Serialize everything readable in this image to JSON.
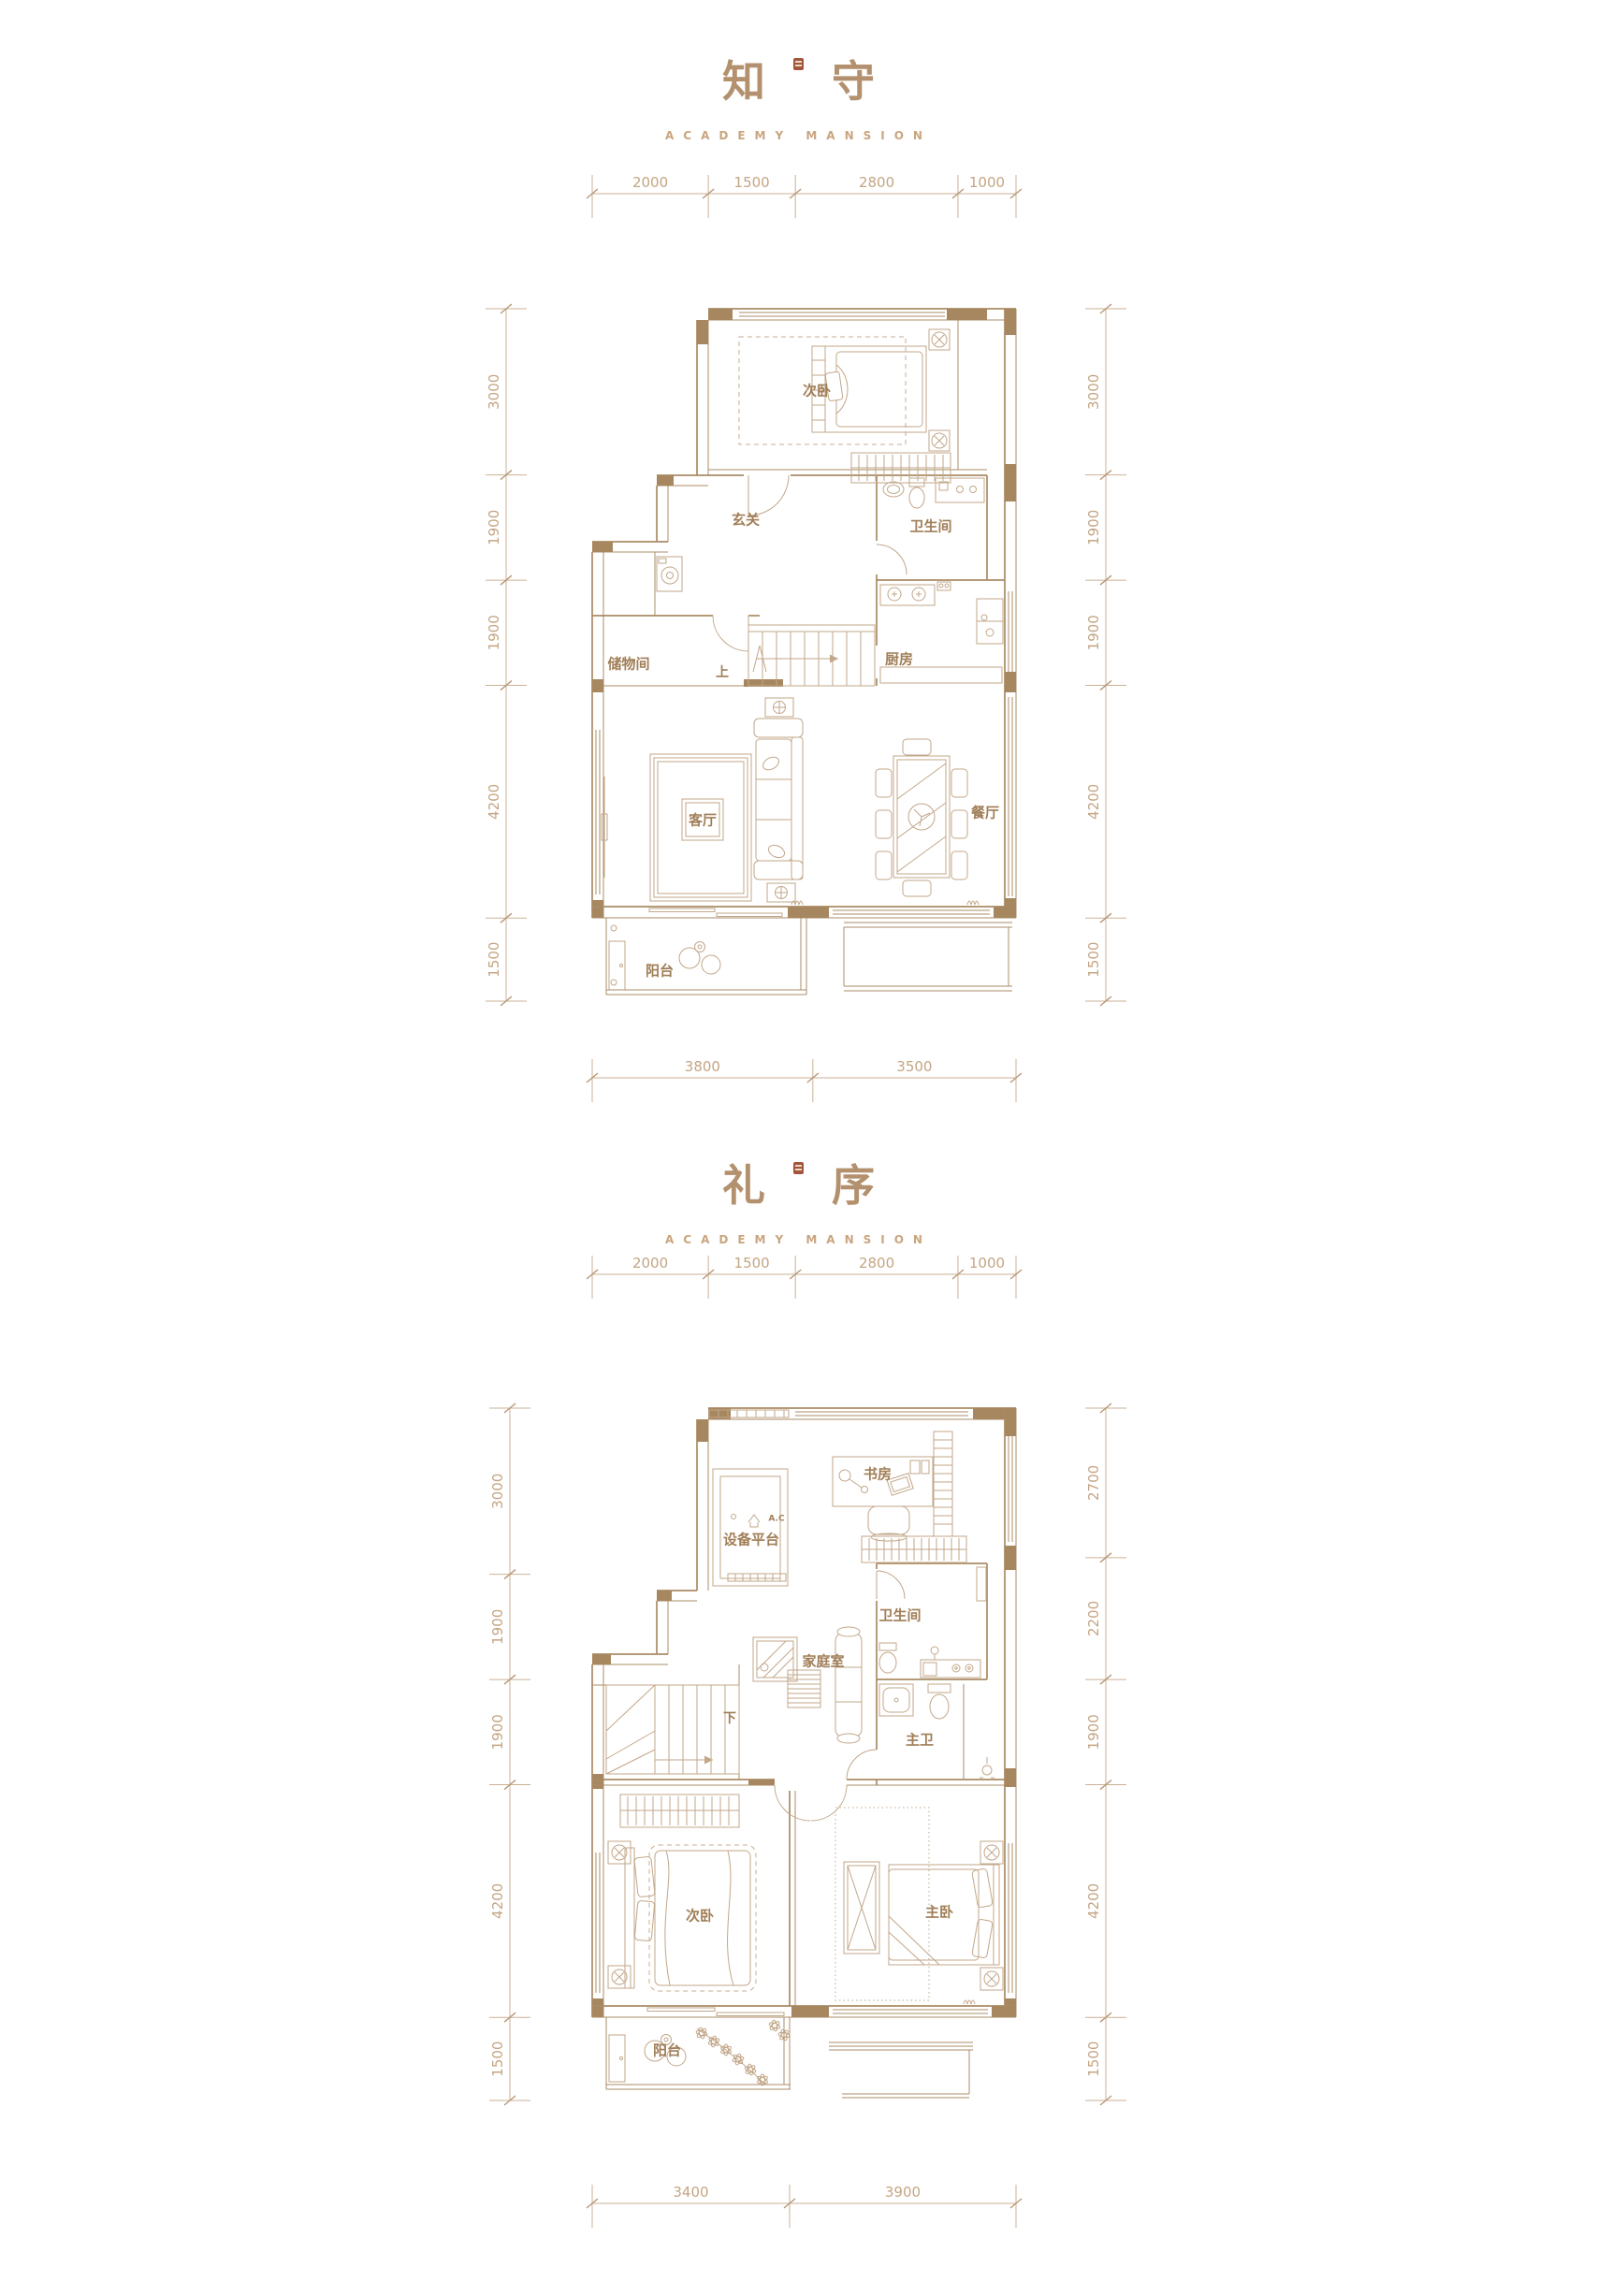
{
  "page": {
    "background": "#ffffff"
  },
  "colors": {
    "wall_fill": "#a7875f",
    "wall_line": "#a98b64",
    "furniture_line": "#c2a78a",
    "dimension": "#cbb296",
    "room_label": "#a07e57",
    "title": "#b3906e",
    "subtitle": "#c9a57e",
    "seal": "#a3563c"
  },
  "plans": [
    {
      "title": {
        "char1": "知",
        "char2": "守"
      },
      "subtitle": "ACADEMY MANSION",
      "dims": {
        "top": [
          "2000",
          "1500",
          "2800",
          "1000"
        ],
        "left": [
          "3000",
          "1900",
          "1900",
          "4200",
          "1500"
        ],
        "right": [
          "3000",
          "1900",
          "1900",
          "4200",
          "1500"
        ],
        "bottom": [
          "3800",
          "3500"
        ]
      },
      "rooms": [
        {
          "name": "secondary-bedroom",
          "label": "次卧"
        },
        {
          "name": "entry-hall",
          "label": "玄关"
        },
        {
          "name": "bathroom",
          "label": "卫生间"
        },
        {
          "name": "kitchen",
          "label": "厨房"
        },
        {
          "name": "storage-room",
          "label": "储物间"
        },
        {
          "name": "living-room",
          "label": "客厅"
        },
        {
          "name": "dining-room",
          "label": "餐厅"
        },
        {
          "name": "balcony",
          "label": "阳台"
        }
      ],
      "annotations": {
        "stair_direction": "上"
      }
    },
    {
      "title": {
        "char1": "礼",
        "char2": "序"
      },
      "subtitle": "ACADEMY MANSION",
      "dims": {
        "top": [
          "2000",
          "1500",
          "2800",
          "1000"
        ],
        "left": [
          "3000",
          "1900",
          "1900",
          "4200",
          "1500"
        ],
        "right": [
          "2700",
          "2200",
          "1900",
          "4200",
          "1500"
        ],
        "bottom": [
          "3400",
          "3900"
        ]
      },
      "rooms": [
        {
          "name": "study",
          "label": "书房"
        },
        {
          "name": "equipment-platform",
          "label": "设备平台"
        },
        {
          "name": "bathroom",
          "label": "卫生间"
        },
        {
          "name": "family-room",
          "label": "家庭室"
        },
        {
          "name": "master-bathroom",
          "label": "主卫"
        },
        {
          "name": "secondary-bedroom",
          "label": "次卧"
        },
        {
          "name": "master-bedroom",
          "label": "主卧"
        },
        {
          "name": "balcony",
          "label": "阳台"
        }
      ],
      "annotations": {
        "stair_direction": "下",
        "ac_unit": "A.C"
      }
    }
  ]
}
